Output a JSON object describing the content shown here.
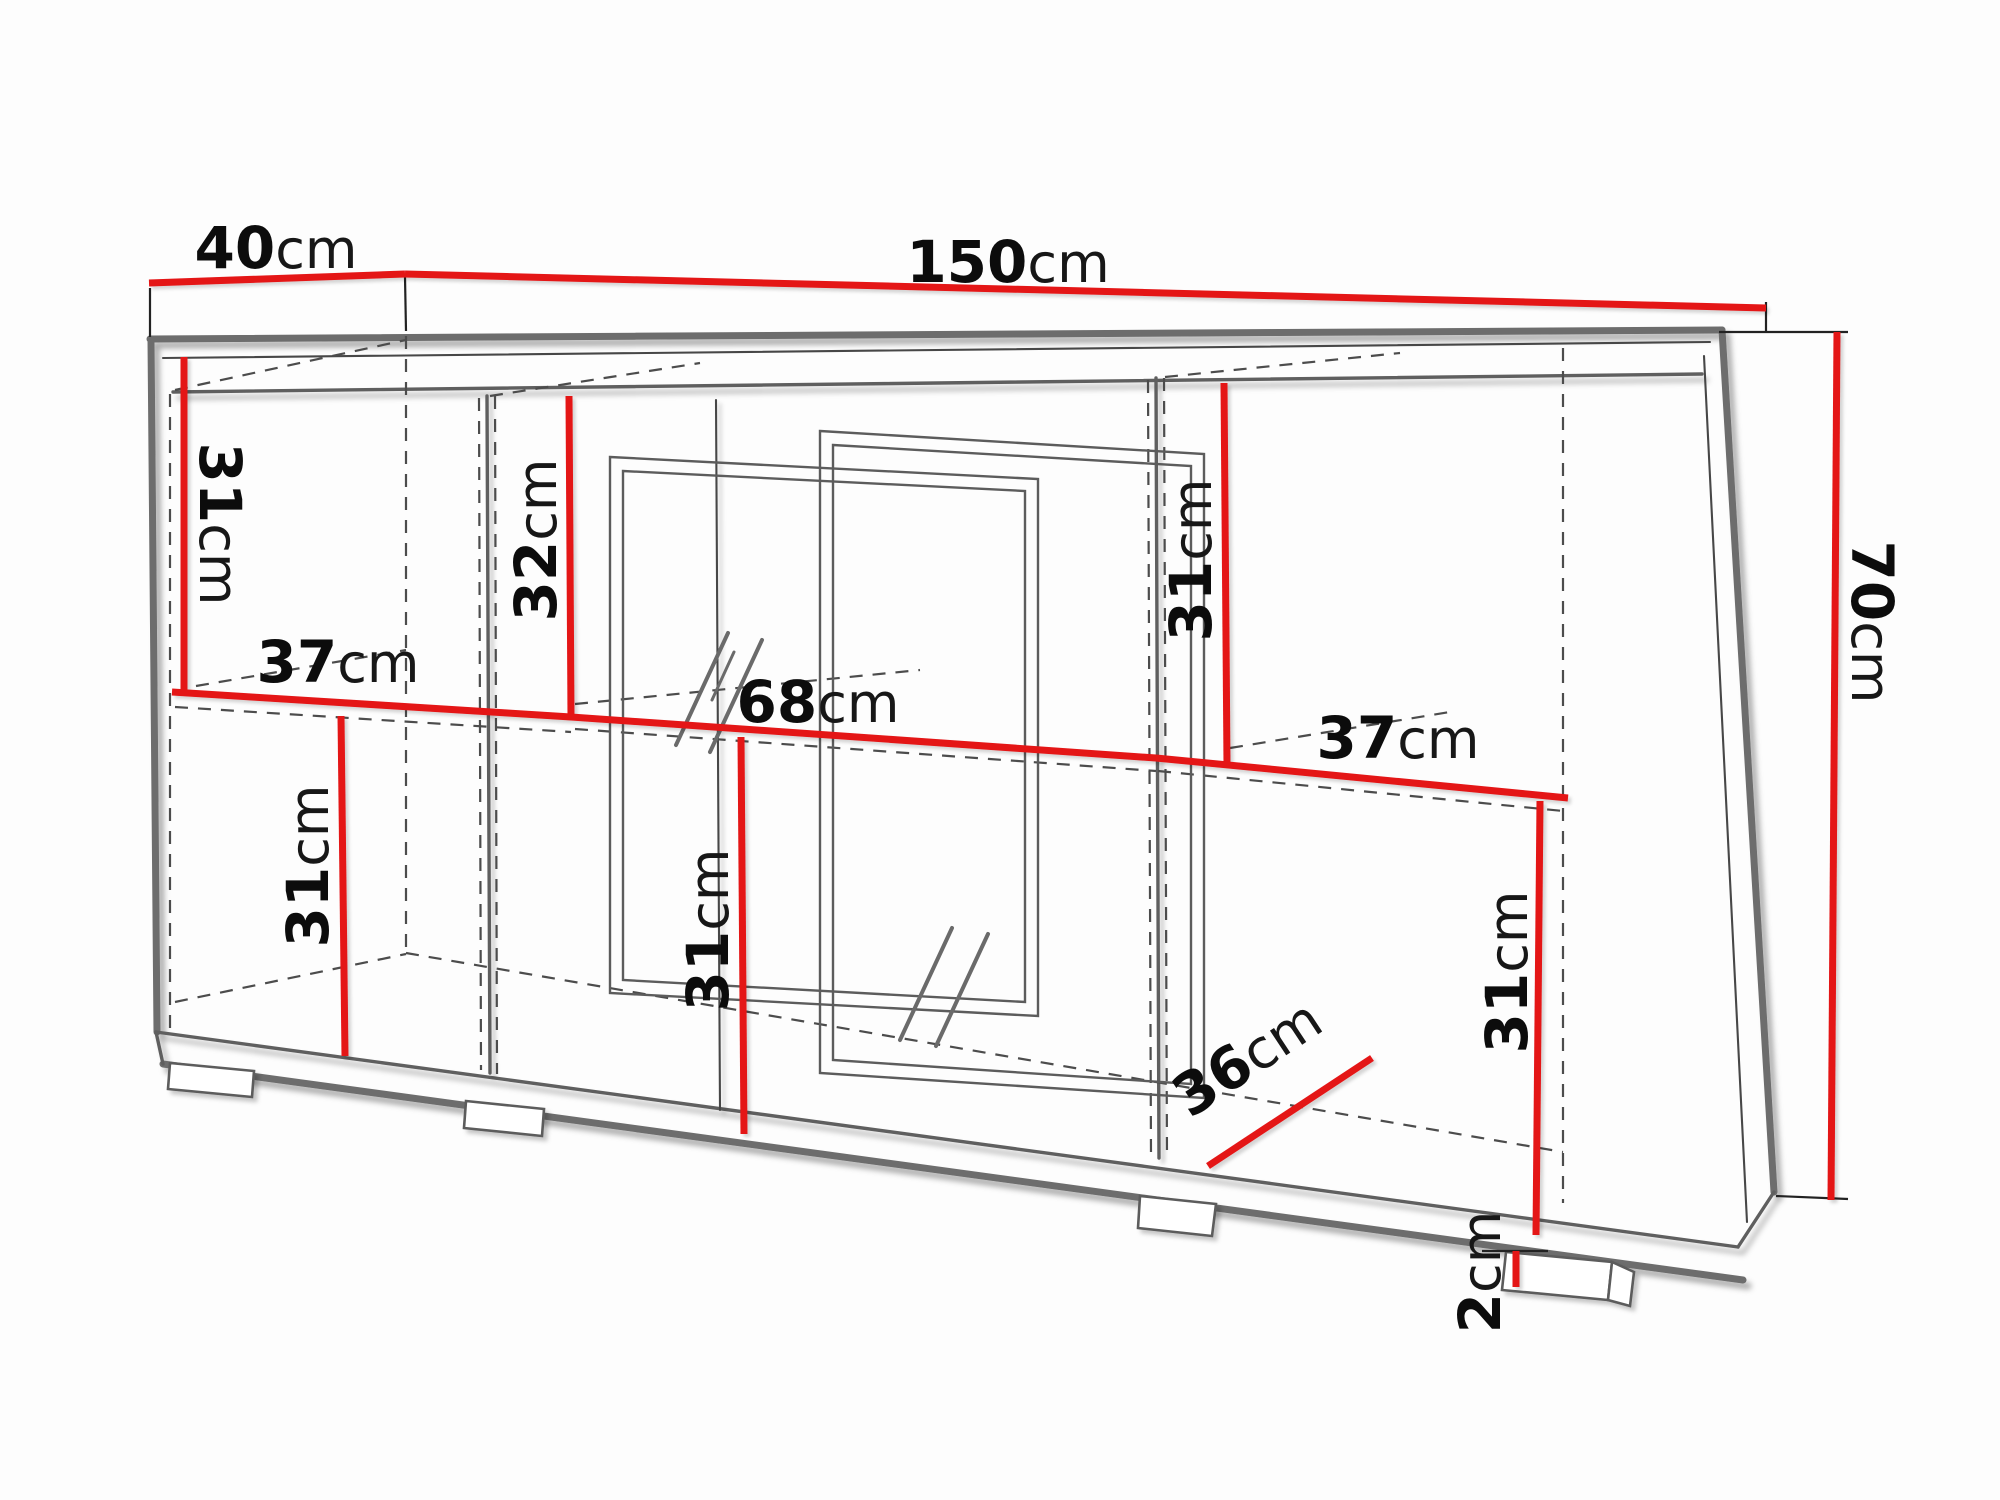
{
  "diagram": {
    "kind": "furniture-dimension-technical-drawing",
    "object": "sideboard with doors, sliding glass doors, shelves and feet",
    "unit": "cm",
    "colors": {
      "dimension_line": "#e41417",
      "outline": "#6d6d6d",
      "background": "#fdfdfd"
    },
    "dims": {
      "depth_top": {
        "v": "40",
        "u": "cm"
      },
      "width_top": {
        "v": "150",
        "u": "cm"
      },
      "height_right": {
        "v": "70",
        "u": "cm"
      },
      "left_upper_h": {
        "v": "31",
        "u": "cm"
      },
      "left_shelf_d": {
        "v": "37",
        "u": "cm"
      },
      "left_lower_h": {
        "v": "31",
        "u": "cm"
      },
      "mid_upper_h": {
        "v": "32",
        "u": "cm"
      },
      "mid_inner_w": {
        "v": "68",
        "u": "cm"
      },
      "mid_lower_h": {
        "v": "31",
        "u": "cm"
      },
      "right_upper_h": {
        "v": "31",
        "u": "cm"
      },
      "right_shelf_d": {
        "v": "37",
        "u": "cm"
      },
      "right_lower_d": {
        "v": "36",
        "u": "cm"
      },
      "right_lower_h": {
        "v": "31",
        "u": "cm"
      },
      "foot_h": {
        "v": "2",
        "u": "cm"
      }
    }
  }
}
